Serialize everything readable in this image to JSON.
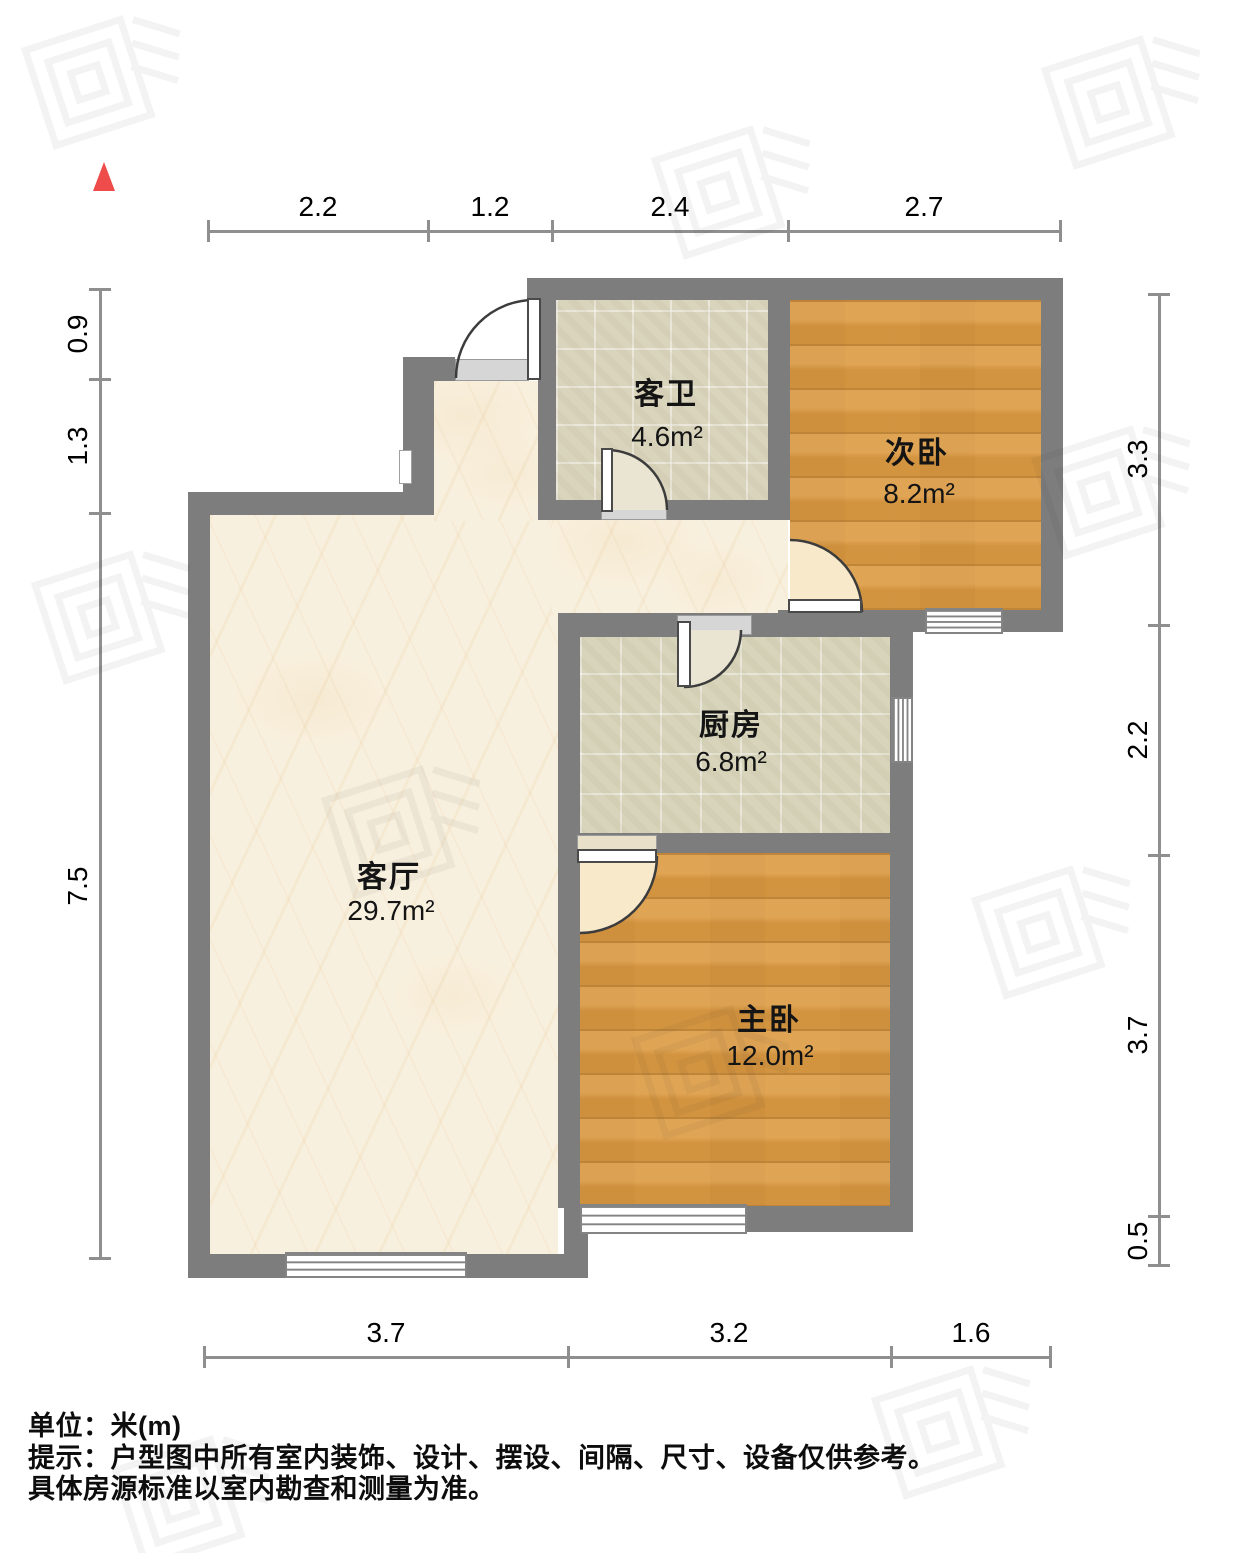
{
  "rooms": {
    "bath": {
      "name": "客卫",
      "area": "4.6m²"
    },
    "bed2": {
      "name": "次卧",
      "area": "8.2m²"
    },
    "kitchen": {
      "name": "厨房",
      "area": "6.8m²"
    },
    "living": {
      "name": "客厅",
      "area": "29.7m²"
    },
    "master": {
      "name": "主卧",
      "area": "12.0m²"
    }
  },
  "dimensions": {
    "top": [
      "2.2",
      "1.2",
      "2.4",
      "2.7"
    ],
    "left": [
      "0.9",
      "1.3",
      "7.5"
    ],
    "right": [
      "3.3",
      "2.2",
      "3.7",
      "0.5"
    ],
    "bottom": [
      "3.7",
      "3.2",
      "1.6"
    ]
  },
  "footer": {
    "unit": "单位：米(m)",
    "tip": "提示：户型图中所有室内装饰、设计、摆设、间隔、尺寸、设备仅供参考。",
    "note": "具体房源标准以室内勘查和测量为准。"
  },
  "colors": {
    "wall": "#7d7d7d",
    "wood": "#dd9c45",
    "tile": "#d9d4bc",
    "marble": "#f8f0de",
    "north": "#ee4c4a"
  }
}
